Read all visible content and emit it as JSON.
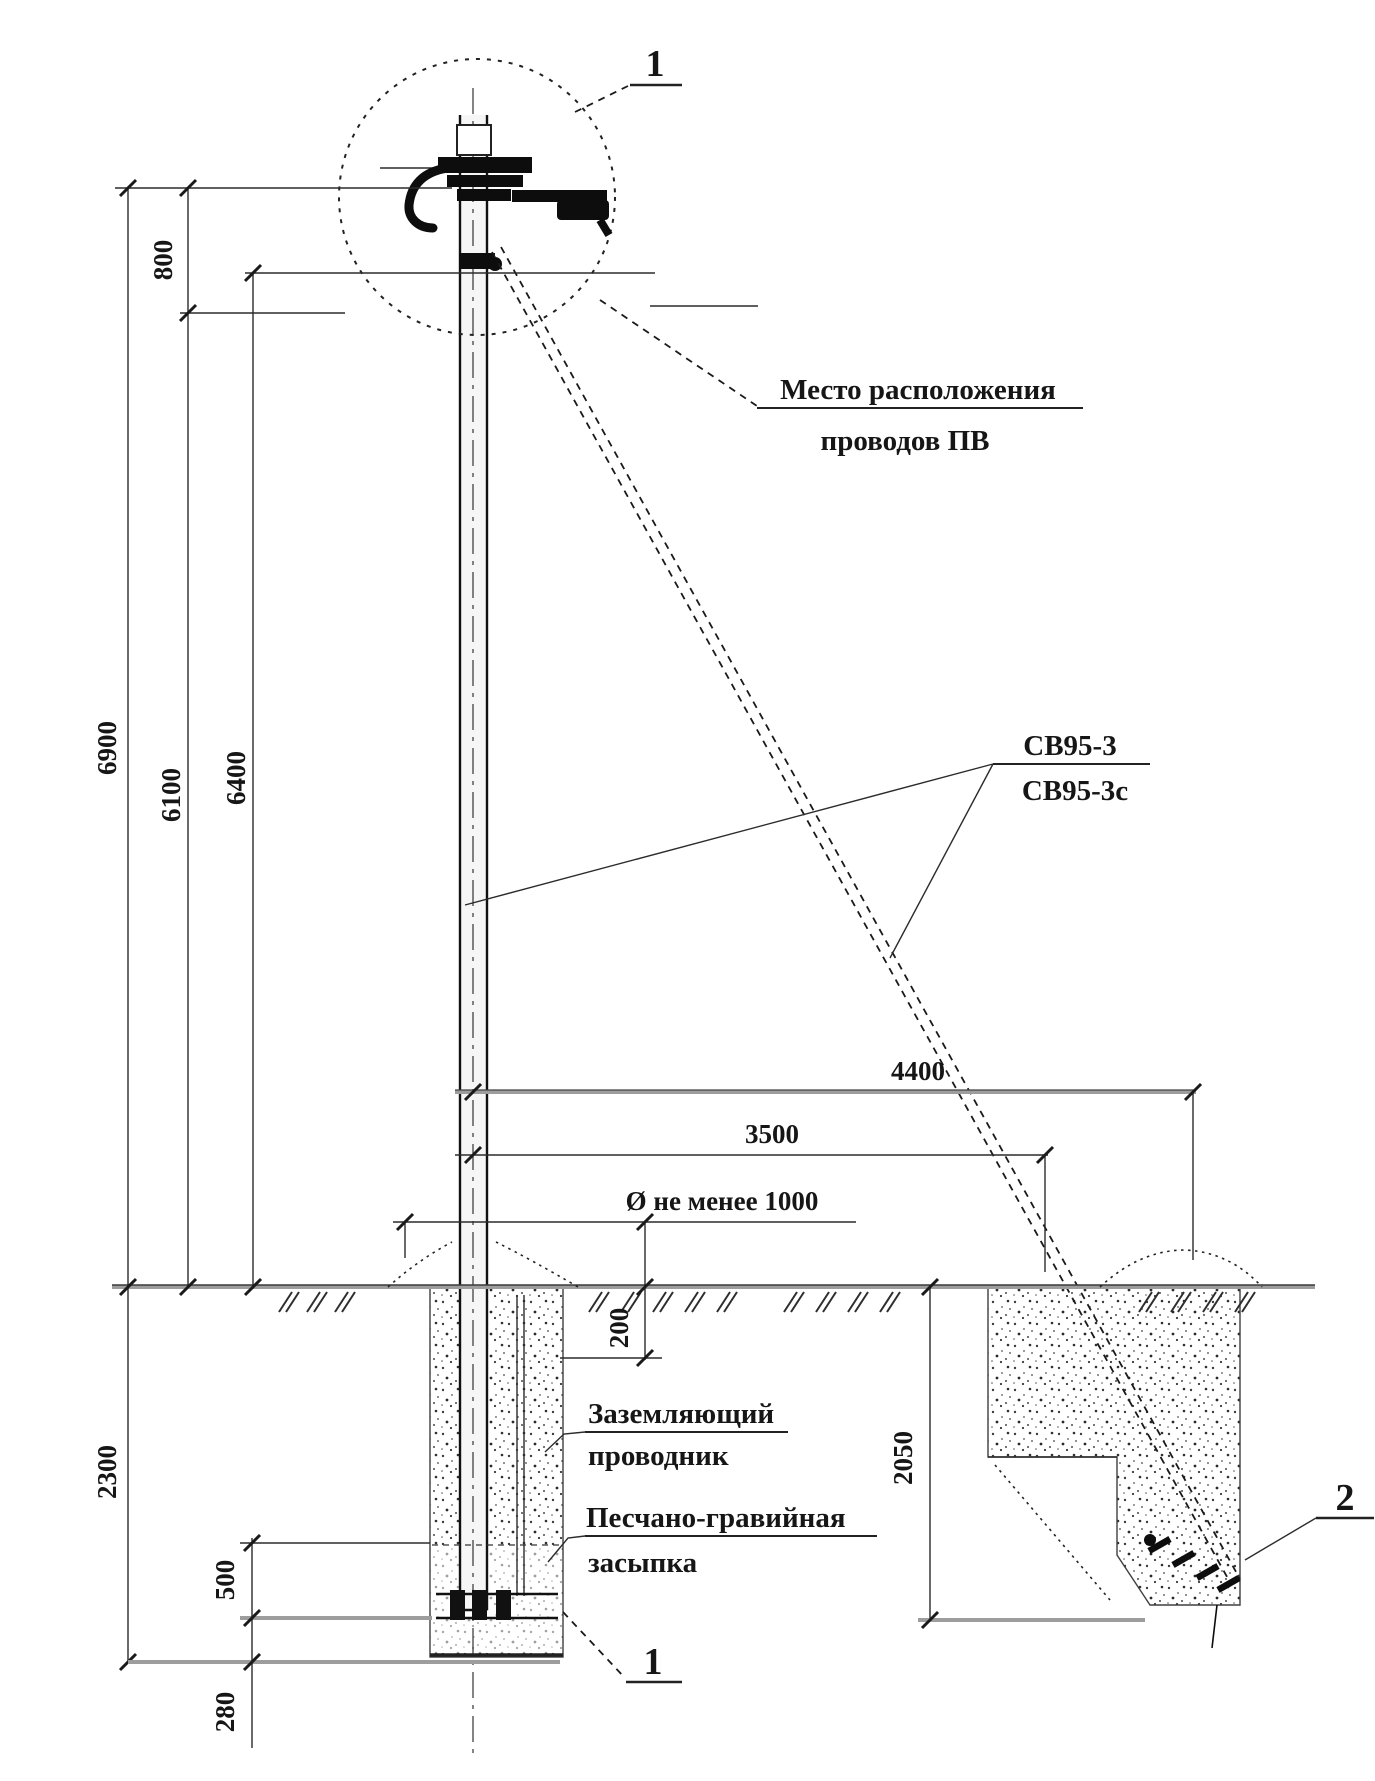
{
  "refs": {
    "detail_top": "1",
    "detail_bottom": "1",
    "anchor": "2"
  },
  "callouts": {
    "wire_location_1": "Место расположения",
    "wire_location_2": "проводов ПВ",
    "pole_type_1": "СВ95-3",
    "pole_type_2": "СВ95-3с",
    "grounding_1": "Заземляющий",
    "grounding_2": "проводник",
    "backfill_1": "Песчано-гравийная",
    "backfill_2": "засыпка"
  },
  "dimensions": {
    "d800": "800",
    "d6900": "6900",
    "d6100": "6100",
    "d6400": "6400",
    "d4400": "4400",
    "d3500": "3500",
    "d_pit_diameter": "Ø не менее 1000",
    "d200": "200",
    "d2300": "2300",
    "d2050": "2050",
    "d500": "500",
    "d280": "280"
  }
}
